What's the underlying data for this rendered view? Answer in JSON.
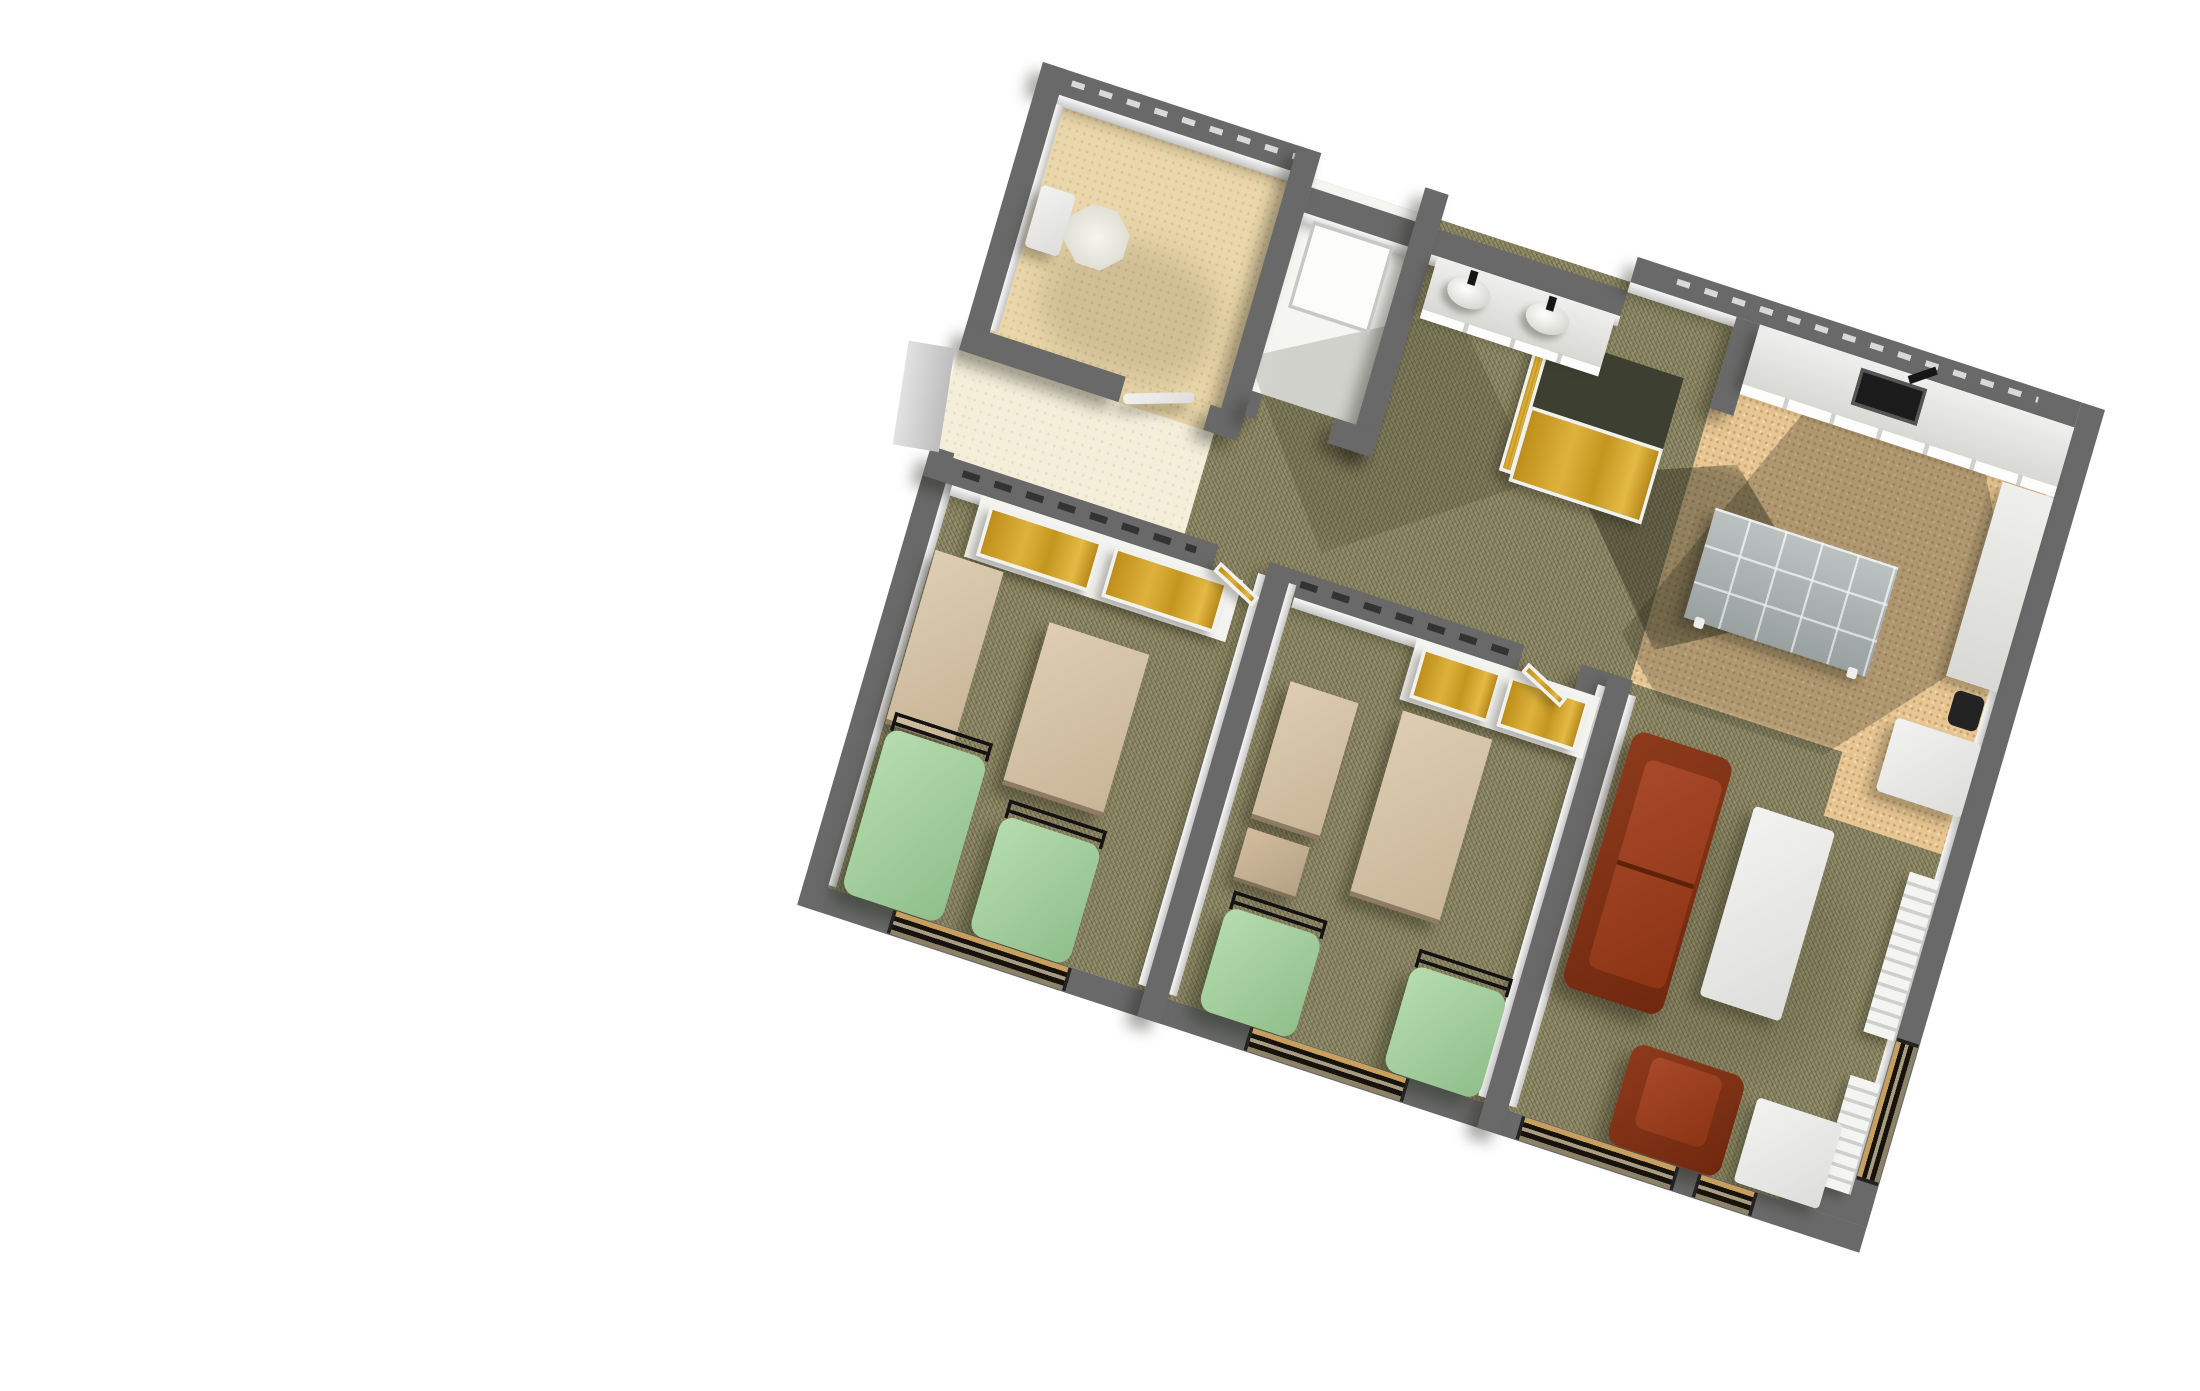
{
  "scene": {
    "type": "3d-floorplan-render",
    "description": "Axonometric bird's-eye 3D render of a student residence suite floor plan on a plain white background, rotated about 18 degrees clockwise. No text, labels or UI controls are visible anywhere in the image.",
    "view": {
      "projection": "axonometric bird's-eye",
      "rotation_deg": 18,
      "background": "#ffffff"
    },
    "palette": {
      "background": "#ffffff",
      "wall_gray": "#696969",
      "wall_face_light": "#f0f0f0",
      "carpet_olive": "#8f8965",
      "bathroom_tile_cream": "#e9d6aa",
      "entry_tile_light": "#f4eedb",
      "kitchen_cork_tan": "#e6c694",
      "wardrobe_gold": "#d2a22a",
      "closet_side_dark": "#3d4030",
      "bedspread_green": "#a5d0a0",
      "bed_rail_black": "#131313",
      "desk_wood_tan": "#d3c1a6",
      "leather_brown": "#8e3a1c",
      "white_furniture": "#ececea",
      "dining_table_gray_tile": "#a6aeae",
      "sink_dark": "#1b1b1b",
      "window_glass_dark": "#17120c",
      "window_sill_tan": "#c8a05e"
    },
    "rooms": [
      {
        "id": "wc",
        "label": "WC",
        "floor": "cream ceramic tile",
        "contents": [
          "toilet with tank against west wall",
          "door to entry hall"
        ]
      },
      {
        "id": "shower-room",
        "label": "Shower room",
        "floor": "white",
        "contents": [
          "square white shower tray"
        ]
      },
      {
        "id": "washstand",
        "label": "Washstand alcove",
        "floor": "olive carpet",
        "contents": [
          "white vanity counter",
          "two white wash basins with faucets"
        ]
      },
      {
        "id": "hallway",
        "label": "Entry hall and corridor",
        "floor": "light tile at entry, olive carpet in corridor",
        "contents": [
          "open entry door on west wall",
          "freestanding wardrobe closet with golden doors and dark top"
        ]
      },
      {
        "id": "kitchen",
        "label": "Kitchen / dining nook",
        "floor": "cork tile",
        "contents": [
          "counter along north wall with dark inset sink and faucet",
          "side counter on east wall",
          "refrigerator block",
          "dark waste bin",
          "gray tiled dining table with white legs"
        ]
      },
      {
        "id": "bedroom-1",
        "label": "Bedroom 1",
        "floor": "olive carpet",
        "contents": [
          "built-in wardrobe with two golden doors",
          "tall dresser on west wall",
          "desk",
          "two single beds with green bedspreads and black metal head rails",
          "window in south wall",
          "golden door leaf at entrance"
        ]
      },
      {
        "id": "bedroom-2",
        "label": "Bedroom 2",
        "floor": "olive carpet",
        "contents": [
          "built-in wardrobe with two golden doors",
          "desk against divider wall",
          "shelf unit",
          "center desk",
          "two single beds with green bedspreads and black metal head rails",
          "window in south wall",
          "golden door leaf at entrance"
        ]
      },
      {
        "id": "living-room",
        "label": "Living room",
        "floor": "olive carpet",
        "contents": [
          "brown leather two-seat sofa",
          "white coffee table",
          "brown leather armchair",
          "white end table",
          "two white wall radiators on east wall",
          "wide and narrow windows in south wall",
          "window in east wall"
        ]
      }
    ],
    "units": "local plan pixels, scene 1000 x 760, transformed to screen"
  },
  "elements": [
    {
      "name": "carpet-floor-main",
      "cls": "carpet",
      "x": 22,
      "y": 22,
      "w": 956,
      "h": 694
    },
    {
      "name": "wc-tile-floor",
      "cls": "tile",
      "x": 22,
      "y": 22,
      "w": 218,
      "h": 208
    },
    {
      "name": "wc-doorway-tile",
      "cls": "tile",
      "x": 150,
      "y": 230,
      "w": 80,
      "h": 22
    },
    {
      "name": "vestibule-tile-floor",
      "cls": "tile-light",
      "x": 22,
      "y": 252,
      "w": 218,
      "h": 88
    },
    {
      "name": "entry-doorway-tile",
      "cls": "tile-light",
      "x": 0,
      "y": 252,
      "w": 22,
      "h": 86
    },
    {
      "name": "shower-room-floor",
      "cls": "whitefloor",
      "x": 262,
      "y": 22,
      "w": 98,
      "h": 186
    },
    {
      "name": "kitchen-cork-floor",
      "cls": "cork",
      "x": 660,
      "y": 22,
      "w": 318,
      "h": 320
    },
    {
      "name": "kitchen-cork-floor-ext",
      "cls": "cork",
      "x": 860,
      "y": 342,
      "w": 118,
      "h": 56
    },
    {
      "name": "kitchen-cast-shadow",
      "cls": "sh-a",
      "x": 640,
      "y": 50,
      "w": 340,
      "h": 300
    },
    {
      "name": "closet-cast-shadow",
      "cls": "sh-b",
      "x": 560,
      "y": 140,
      "w": 250,
      "h": 170
    },
    {
      "name": "corridor-cast-shadow",
      "cls": "sh-c",
      "x": 250,
      "y": 90,
      "w": 280,
      "h": 230
    },
    {
      "name": "living-room-soft-shadow",
      "cls": "sh-d",
      "x": 672,
      "y": 430,
      "w": 240,
      "h": 200
    },
    {
      "name": "wc-soft-shadow",
      "cls": "sh-e",
      "x": 56,
      "y": 120,
      "w": 160,
      "h": 110
    },
    {
      "name": "north-wall-west",
      "cls": "wall wsh",
      "x": 0,
      "y": 0,
      "w": 262,
      "h": 22
    },
    {
      "name": "north-wall-west-face",
      "cls": "face",
      "x": 22,
      "y": 22,
      "w": 218,
      "h": 9
    },
    {
      "name": "north-wall-center",
      "cls": "wall wsh",
      "x": 262,
      "y": 30,
      "w": 298,
      "h": 22
    },
    {
      "name": "north-wall-center-face",
      "cls": "face",
      "x": 262,
      "y": 52,
      "w": 298,
      "h": 9
    },
    {
      "name": "north-wall-east",
      "cls": "wall wsh",
      "x": 560,
      "y": 0,
      "w": 418,
      "h": 22
    },
    {
      "name": "north-wall-east-face",
      "cls": "face",
      "x": 560,
      "y": 22,
      "w": 418,
      "h": 9
    },
    {
      "name": "north-wall-west-dashes",
      "cls": "dash-light",
      "x": 30,
      "y": 7,
      "w": 210,
      "h": 5
    },
    {
      "name": "north-wall-east-dashes",
      "cls": "dash-light",
      "x": 600,
      "y": 7,
      "w": 340,
      "h": 5
    },
    {
      "name": "west-wall-north",
      "cls": "wall",
      "x": 0,
      "y": 0,
      "w": 22,
      "h": 252
    },
    {
      "name": "west-wall-south",
      "cls": "wall",
      "x": 0,
      "y": 336,
      "w": 22,
      "h": 402
    },
    {
      "name": "west-wall-face-wc",
      "cls": "face-v",
      "x": 22,
      "y": 30,
      "w": 7,
      "h": 198
    },
    {
      "name": "west-wall-face-bedroom1",
      "cls": "face-v",
      "x": 22,
      "y": 362,
      "w": 7,
      "h": 352
    },
    {
      "name": "east-wall",
      "cls": "wall",
      "x": 978,
      "y": 0,
      "w": 22,
      "h": 716
    },
    {
      "name": "east-wall-face",
      "cls": "face-v",
      "x": 971,
      "y": 30,
      "w": 7,
      "h": 680
    },
    {
      "name": "south-wall",
      "cls": "wall",
      "x": 0,
      "y": 716,
      "w": 1000,
      "h": 22
    },
    {
      "name": "south-east-notch",
      "cls": "wall",
      "x": 918,
      "y": 694,
      "w": 82,
      "h": 22
    },
    {
      "name": "wc-east-wall",
      "cls": "wall wsh",
      "x": 240,
      "y": 0,
      "w": 22,
      "h": 230
    },
    {
      "name": "wc-south-wall-west",
      "cls": "wall wsh",
      "x": 0,
      "y": 230,
      "w": 150,
      "h": 22
    },
    {
      "name": "wc-south-wall-east",
      "cls": "wall wsh",
      "x": 230,
      "y": 230,
      "w": 32,
      "h": 22
    },
    {
      "name": "shower-east-wall",
      "cls": "wall wsh",
      "x": 360,
      "y": 0,
      "w": 22,
      "h": 230
    },
    {
      "name": "shower-south-wall-west",
      "cls": "wall wsh",
      "x": 262,
      "y": 208,
      "w": 10,
      "h": 22
    },
    {
      "name": "shower-south-wall-east",
      "cls": "wall wsh",
      "x": 340,
      "y": 208,
      "w": 42,
      "h": 22
    },
    {
      "name": "bedroom1-north-wall",
      "cls": "wall wsh",
      "x": 0,
      "y": 340,
      "w": 272,
      "h": 22
    },
    {
      "name": "bedroom1-north-wall-face",
      "cls": "face",
      "x": 28,
      "y": 362,
      "w": 236,
      "h": 9
    },
    {
      "name": "bedroom1-wall-dashes",
      "cls": "dash",
      "x": 34,
      "y": 347,
      "w": 220,
      "h": 6
    },
    {
      "name": "bedroom2-north-wall-west",
      "cls": "wall wsh",
      "x": 342,
      "y": 340,
      "w": 218,
      "h": 22
    },
    {
      "name": "bedroom2-north-wall-east",
      "cls": "wall wsh",
      "x": 614,
      "y": 340,
      "w": 48,
      "h": 22
    },
    {
      "name": "bedroom2-north-wall-face",
      "cls": "face",
      "x": 350,
      "y": 362,
      "w": 202,
      "h": 9
    },
    {
      "name": "bedroom2-wall-dashes",
      "cls": "dash",
      "x": 352,
      "y": 347,
      "w": 196,
      "h": 6
    },
    {
      "name": "divider-wall-1",
      "cls": "wall wsh",
      "x": 320,
      "y": 340,
      "w": 22,
      "h": 398
    },
    {
      "name": "divider-wall-1-face-west",
      "cls": "face-v",
      "x": 313,
      "y": 352,
      "w": 7,
      "h": 360
    },
    {
      "name": "divider-wall-1-face-east",
      "cls": "face-v",
      "x": 342,
      "y": 352,
      "w": 7,
      "h": 360
    },
    {
      "name": "divider-wall-2",
      "cls": "wall wsh",
      "x": 640,
      "y": 340,
      "w": 22,
      "h": 398
    },
    {
      "name": "divider-wall-2-face-west",
      "cls": "face-v",
      "x": 633,
      "y": 352,
      "w": 7,
      "h": 360
    },
    {
      "name": "divider-wall-2-face-east",
      "cls": "face-v",
      "x": 662,
      "y": 352,
      "w": 7,
      "h": 360
    },
    {
      "name": "kitchen-west-wall-stub",
      "cls": "wall wsh",
      "x": 660,
      "y": 22,
      "w": 22,
      "h": 80
    },
    {
      "name": "hall-closet-top",
      "cls": "closet-dark",
      "x": 505,
      "y": 85,
      "w": 125,
      "h": 62
    },
    {
      "name": "hall-closet-gold-doors",
      "cls": "gold",
      "x": 505,
      "y": 147,
      "w": 125,
      "h": 66
    },
    {
      "name": "hall-closet-gold-side",
      "cls": "gold",
      "x": 494,
      "y": 95,
      "w": 13,
      "h": 112
    },
    {
      "name": "bedroom1-wardrobe-frame",
      "cls": "white-frame",
      "x": 56,
      "y": 362,
      "w": 246,
      "h": 54
    },
    {
      "name": "bedroom1-wardrobe-door-left",
      "cls": "gold",
      "x": 66,
      "y": 368,
      "w": 106,
      "h": 44
    },
    {
      "name": "bedroom1-wardrobe-door-right",
      "cls": "gold",
      "x": 184,
      "y": 368,
      "w": 106,
      "h": 44
    },
    {
      "name": "bedroom2-wardrobe-frame",
      "cls": "white-frame",
      "x": 466,
      "y": 362,
      "w": 172,
      "h": 54
    },
    {
      "name": "bedroom2-wardrobe-door-left",
      "cls": "gold",
      "x": 474,
      "y": 368,
      "w": 74,
      "h": 44
    },
    {
      "name": "bedroom2-wardrobe-door-right",
      "cls": "gold",
      "x": 556,
      "y": 368,
      "w": 74,
      "h": 44
    },
    {
      "name": "bedroom1-door-leaf",
      "cls": "gold rot24",
      "x": 274,
      "y": 352,
      "w": 46,
      "h": 10
    },
    {
      "name": "bedroom2-door-leaf",
      "cls": "gold rot24",
      "x": 564,
      "y": 352,
      "w": 46,
      "h": 10
    },
    {
      "name": "wc-door-leaf",
      "cls": "whitefurn rotm18",
      "x": 152,
      "y": 244,
      "w": 64,
      "h": 9
    },
    {
      "name": "entry-door-leaf",
      "cls": "door-gray rotm8",
      "x": -46,
      "y": 252,
      "w": 42,
      "h": 88
    },
    {
      "name": "vanity-counter",
      "cls": "counter",
      "x": 388,
      "y": 52,
      "w": 168,
      "h": 46
    },
    {
      "name": "vanity-counter-front",
      "cls": "counter-face",
      "x": 388,
      "y": 98,
      "w": 168,
      "h": 8
    },
    {
      "name": "wash-basin-left",
      "cls": "basin",
      "x": 404,
      "y": 60,
      "w": 40,
      "h": 26
    },
    {
      "name": "wash-basin-right",
      "cls": "basin",
      "x": 478,
      "y": 60,
      "w": 40,
      "h": 26
    },
    {
      "name": "basin-faucet-left",
      "cls": "black",
      "x": 420,
      "y": 54,
      "w": 7,
      "h": 12
    },
    {
      "name": "basin-faucet-right",
      "cls": "black",
      "x": 494,
      "y": 54,
      "w": 7,
      "h": 12
    },
    {
      "name": "kitchen-counter",
      "cls": "counter",
      "x": 682,
      "y": 22,
      "w": 296,
      "h": 52
    },
    {
      "name": "kitchen-counter-front",
      "cls": "counter-face",
      "x": 682,
      "y": 74,
      "w": 296,
      "h": 9
    },
    {
      "name": "kitchen-sink",
      "cls": "sink-dark",
      "x": 780,
      "y": 30,
      "w": 62,
      "h": 32
    },
    {
      "name": "kitchen-faucet",
      "cls": "black rotm35",
      "x": 824,
      "y": 24,
      "w": 26,
      "h": 7
    },
    {
      "name": "kitchen-side-counter",
      "cls": "counter",
      "x": 930,
      "y": 84,
      "w": 48,
      "h": 170
    },
    {
      "name": "kitchen-waste-bin",
      "cls": "bin",
      "x": 942,
      "y": 262,
      "w": 28,
      "h": 30
    },
    {
      "name": "kitchen-fridge",
      "cls": "whitefurn",
      "x": 898,
      "y": 300,
      "w": 80,
      "h": 64
    },
    {
      "name": "dining-table",
      "cls": "graytile",
      "x": 690,
      "y": 180,
      "w": 172,
      "h": 96
    },
    {
      "name": "dining-table-leg-left",
      "cls": "leg",
      "x": 700,
      "y": 272,
      "w": 9,
      "h": 9
    },
    {
      "name": "dining-table-leg-right",
      "cls": "leg",
      "x": 844,
      "y": 272,
      "w": 9,
      "h": 9
    },
    {
      "name": "toilet-tank",
      "cls": "whitefurn",
      "x": 30,
      "y": 98,
      "w": 32,
      "h": 54
    },
    {
      "name": "toilet-bowl",
      "cls": "toilet",
      "x": 62,
      "y": 100,
      "w": 56,
      "h": 52
    },
    {
      "name": "shower-tray",
      "cls": "tray",
      "x": 272,
      "y": 56,
      "w": 76,
      "h": 76
    },
    {
      "name": "sofa-base",
      "cls": "leather-dark",
      "x": 676,
      "y": 378,
      "w": 94,
      "h": 224
    },
    {
      "name": "sofa-seat-cushions",
      "cls": "leather",
      "x": 694,
      "y": 398,
      "w": 72,
      "h": 182
    },
    {
      "name": "sofa-cushion-split",
      "cls": "leather-line",
      "x": 694,
      "y": 487,
      "w": 72,
      "h": 4
    },
    {
      "name": "coffee-table",
      "cls": "whitefurn",
      "x": 798,
      "y": 408,
      "w": 76,
      "h": 166
    },
    {
      "name": "radiator-east-north",
      "cls": "radiator",
      "x": 948,
      "y": 420,
      "w": 28,
      "h": 140
    },
    {
      "name": "radiator-east-south",
      "cls": "radiator",
      "x": 948,
      "y": 598,
      "w": 28,
      "h": 96
    },
    {
      "name": "armchair-base",
      "cls": "leather-dark",
      "x": 754,
      "y": 628,
      "w": 106,
      "h": 88
    },
    {
      "name": "armchair-seat",
      "cls": "leather",
      "x": 774,
      "y": 634,
      "w": 66,
      "h": 62
    },
    {
      "name": "end-table",
      "cls": "whitefurn",
      "x": 874,
      "y": 640,
      "w": 80,
      "h": 74
    },
    {
      "name": "bedroom1-dresser",
      "cls": "wood",
      "x": 30,
      "y": 418,
      "w": 64,
      "h": 152
    },
    {
      "name": "bedroom1-desk",
      "cls": "wood",
      "x": 146,
      "y": 446,
      "w": 94,
      "h": 142
    },
    {
      "name": "bed1a-head-rail",
      "cls": "rail",
      "x": 36,
      "y": 558,
      "w": 92,
      "h": 16
    },
    {
      "name": "bed1a-mattress",
      "cls": "bed",
      "x": 34,
      "y": 572,
      "w": 94,
      "h": 144
    },
    {
      "name": "bed1b-head-rail",
      "cls": "rail",
      "x": 156,
      "y": 598,
      "w": 92,
      "h": 16
    },
    {
      "name": "bed1b-mattress",
      "cls": "bed",
      "x": 154,
      "y": 612,
      "w": 94,
      "h": 104
    },
    {
      "name": "bedroom2-desk-west",
      "cls": "wood",
      "x": 368,
      "y": 430,
      "w": 64,
      "h": 120
    },
    {
      "name": "bedroom2-shelf-unit",
      "cls": "wood-dark",
      "x": 368,
      "y": 558,
      "w": 58,
      "h": 46
    },
    {
      "name": "bed2a-head-rail",
      "cls": "rail",
      "x": 372,
      "y": 612,
      "w": 88,
      "h": 16
    },
    {
      "name": "bed2a-mattress",
      "cls": "bed",
      "x": 370,
      "y": 626,
      "w": 90,
      "h": 90
    },
    {
      "name": "bedroom2-desk-center",
      "cls": "wood",
      "x": 472,
      "y": 424,
      "w": 84,
      "h": 162
    },
    {
      "name": "bed2b-head-rail",
      "cls": "rail",
      "x": 546,
      "y": 610,
      "w": 88,
      "h": 16
    },
    {
      "name": "bed2b-mattress",
      "cls": "bed",
      "x": 544,
      "y": 624,
      "w": 90,
      "h": 92
    },
    {
      "name": "window-bedroom1",
      "cls": "win-h",
      "x": 84,
      "y": 717,
      "w": 168,
      "h": 20
    },
    {
      "name": "window-bedroom2",
      "cls": "win-h",
      "x": 420,
      "y": 717,
      "w": 150,
      "h": 20
    },
    {
      "name": "window-living-wide",
      "cls": "win-h",
      "x": 676,
      "y": 717,
      "w": 148,
      "h": 20
    },
    {
      "name": "window-living-narrow",
      "cls": "win-h",
      "x": 842,
      "y": 717,
      "w": 56,
      "h": 20
    },
    {
      "name": "window-east-wall",
      "cls": "win-v",
      "x": 979,
      "y": 556,
      "w": 20,
      "h": 124
    }
  ]
}
